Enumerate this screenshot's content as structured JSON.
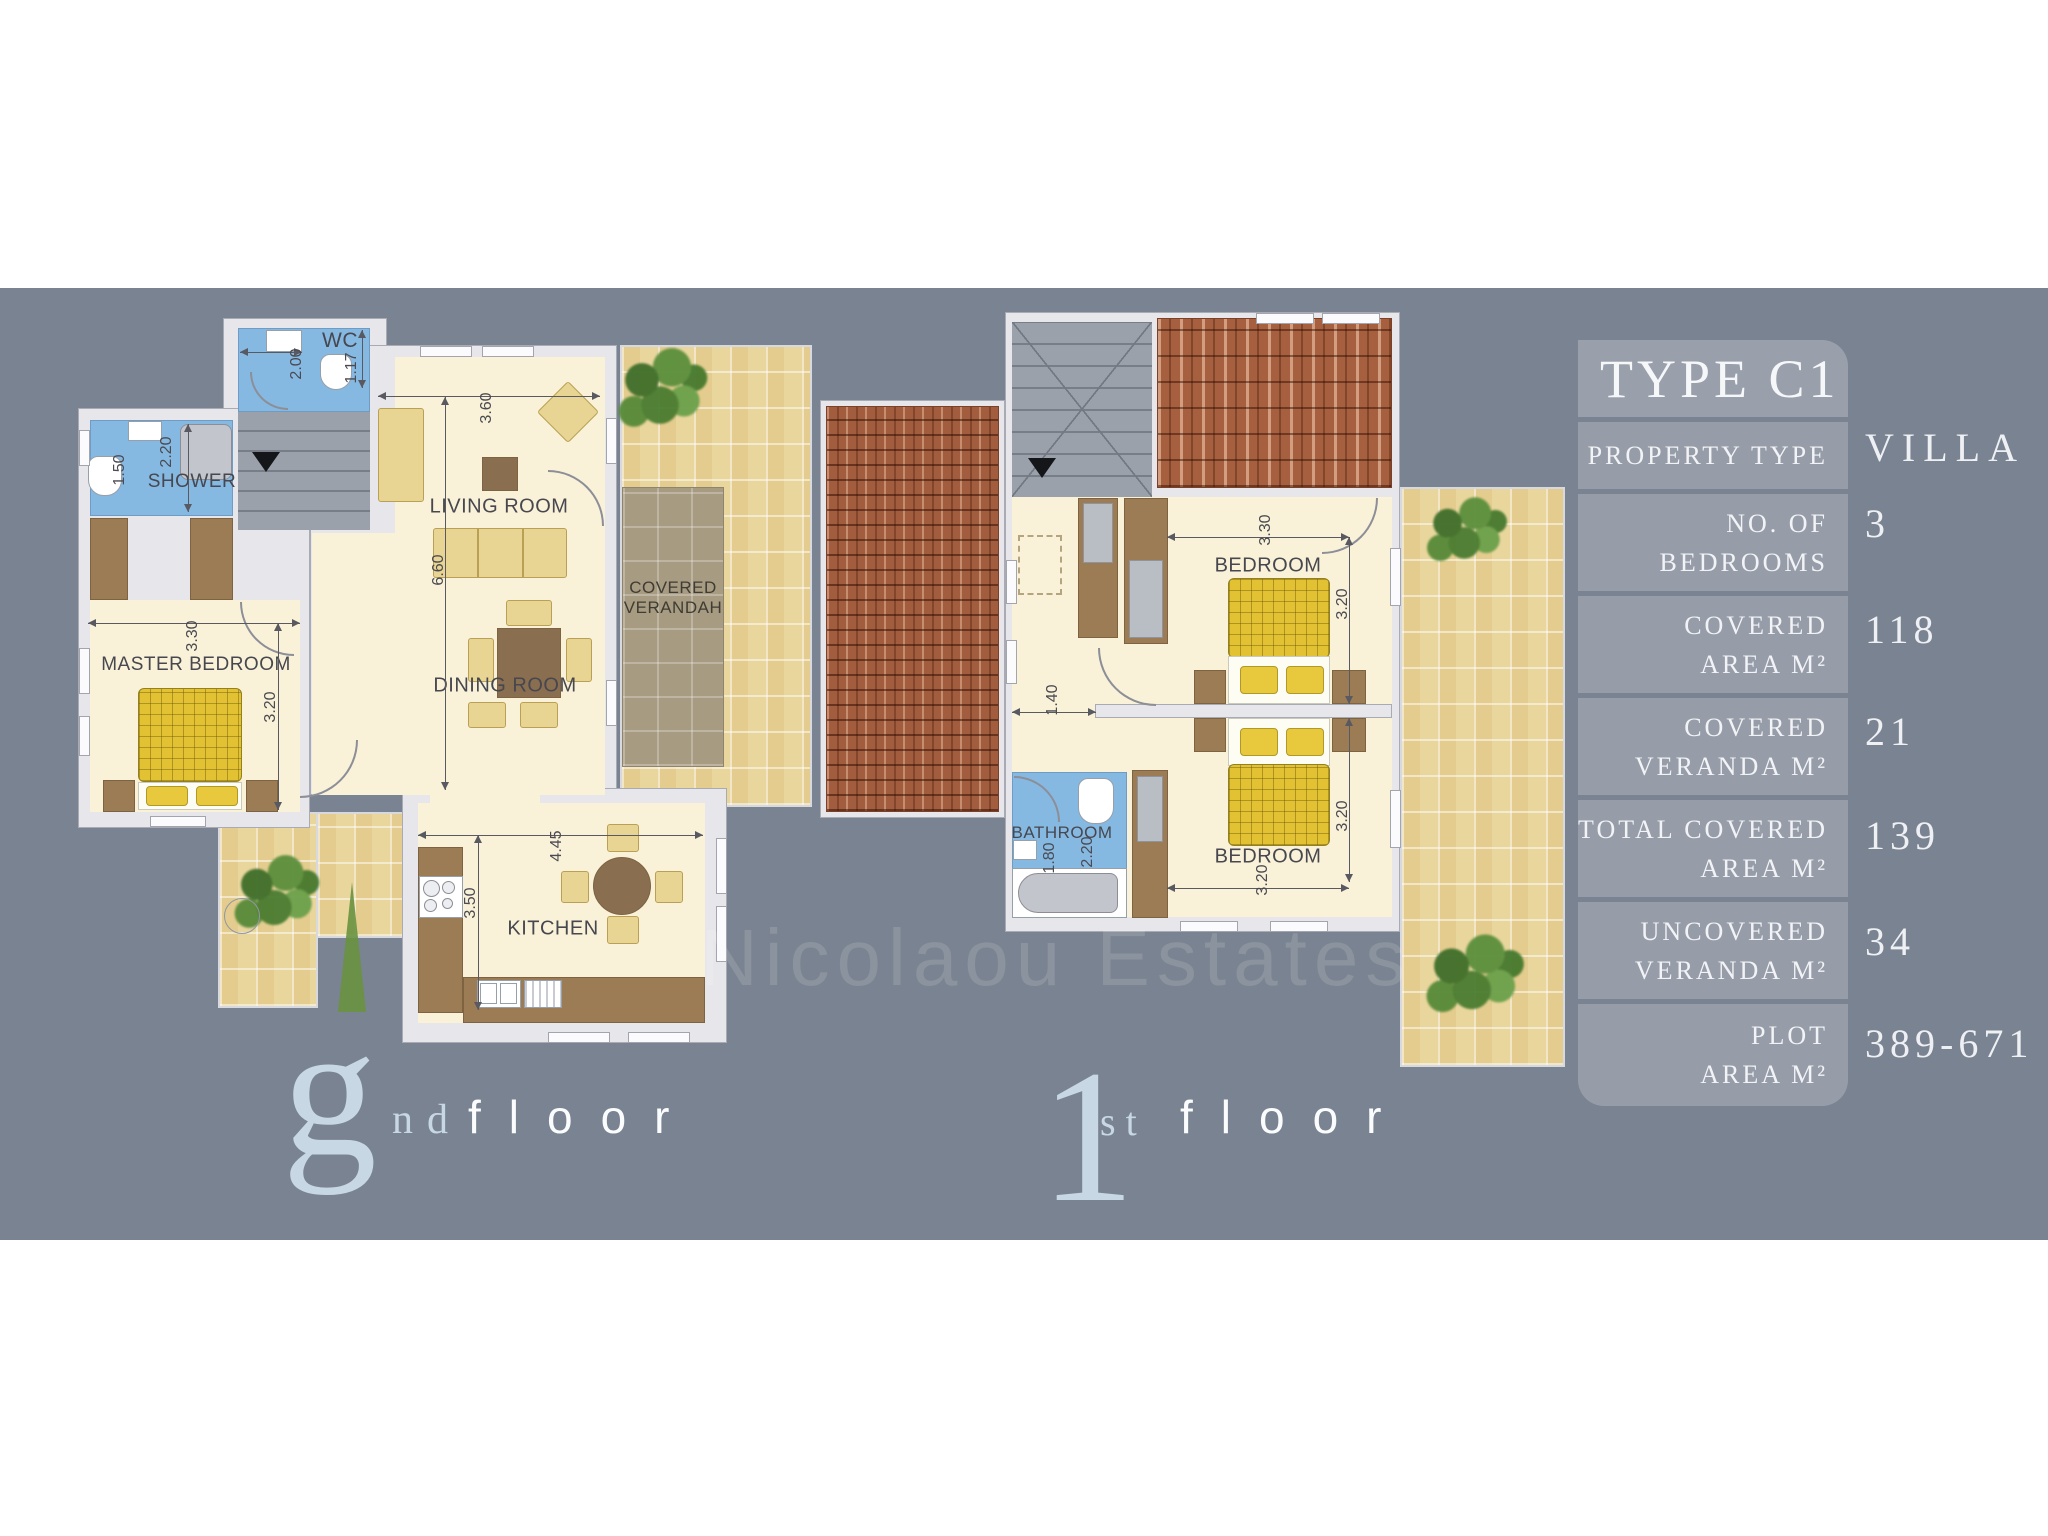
{
  "panel": {
    "title": "TYPE C1",
    "rows": [
      {
        "l1": "PROPERTY TYPE",
        "l2": "",
        "value": "VILLA"
      },
      {
        "l1": "NO. OF",
        "l2": "BEDROOMS",
        "value": "3"
      },
      {
        "l1": "COVERED",
        "l2": "AREA M²",
        "value": "118"
      },
      {
        "l1": "COVERED",
        "l2": "VERANDA M²",
        "value": "21"
      },
      {
        "l1": "TOTAL COVERED",
        "l2": "AREA M²",
        "value": "139"
      },
      {
        "l1": "UNCOVERED",
        "l2": "VERANDA M²",
        "value": "34"
      },
      {
        "l1": "PLOT",
        "l2": "AREA M²",
        "value": "389-671"
      }
    ]
  },
  "watermark": "Nicolaou Estates",
  "ground_floor": {
    "label": {
      "initial": "g",
      "ordinal": "nd",
      "word": "floor"
    },
    "rooms": {
      "wc": "WC",
      "shower": "SHOWER",
      "master_bedroom": "MASTER BEDROOM",
      "living_room": "LIVING ROOM",
      "dining_room": "DINING ROOM",
      "kitchen": "KITCHEN",
      "verandah_line1": "COVERED",
      "verandah_line2": "VERANDAH"
    },
    "dims": {
      "wc_width": "2.00",
      "wc_depth": "1.17",
      "shower_width": "2.20",
      "shower_depth": "1.50",
      "master_width": "3.30",
      "master_depth": "3.20",
      "living_width": "3.60",
      "living_depth": "6.60",
      "kitchen_width": "4.45",
      "kitchen_depth": "3.50"
    }
  },
  "first_floor": {
    "label": {
      "initial": "1",
      "ordinal": "st",
      "word": "floor"
    },
    "rooms": {
      "bedroom_top": "BEDROOM",
      "bedroom_bottom": "BEDROOM",
      "bathroom": "BATHROOM"
    },
    "dims": {
      "bedroom_top_width": "3.30",
      "bedroom_top_depth": "3.20",
      "hall_width": "1.40",
      "bedroom_bottom_depth": "3.20",
      "bedroom_bottom_width": "3.20",
      "bathroom_width": "1.80",
      "bathroom_depth": "2.20"
    }
  }
}
